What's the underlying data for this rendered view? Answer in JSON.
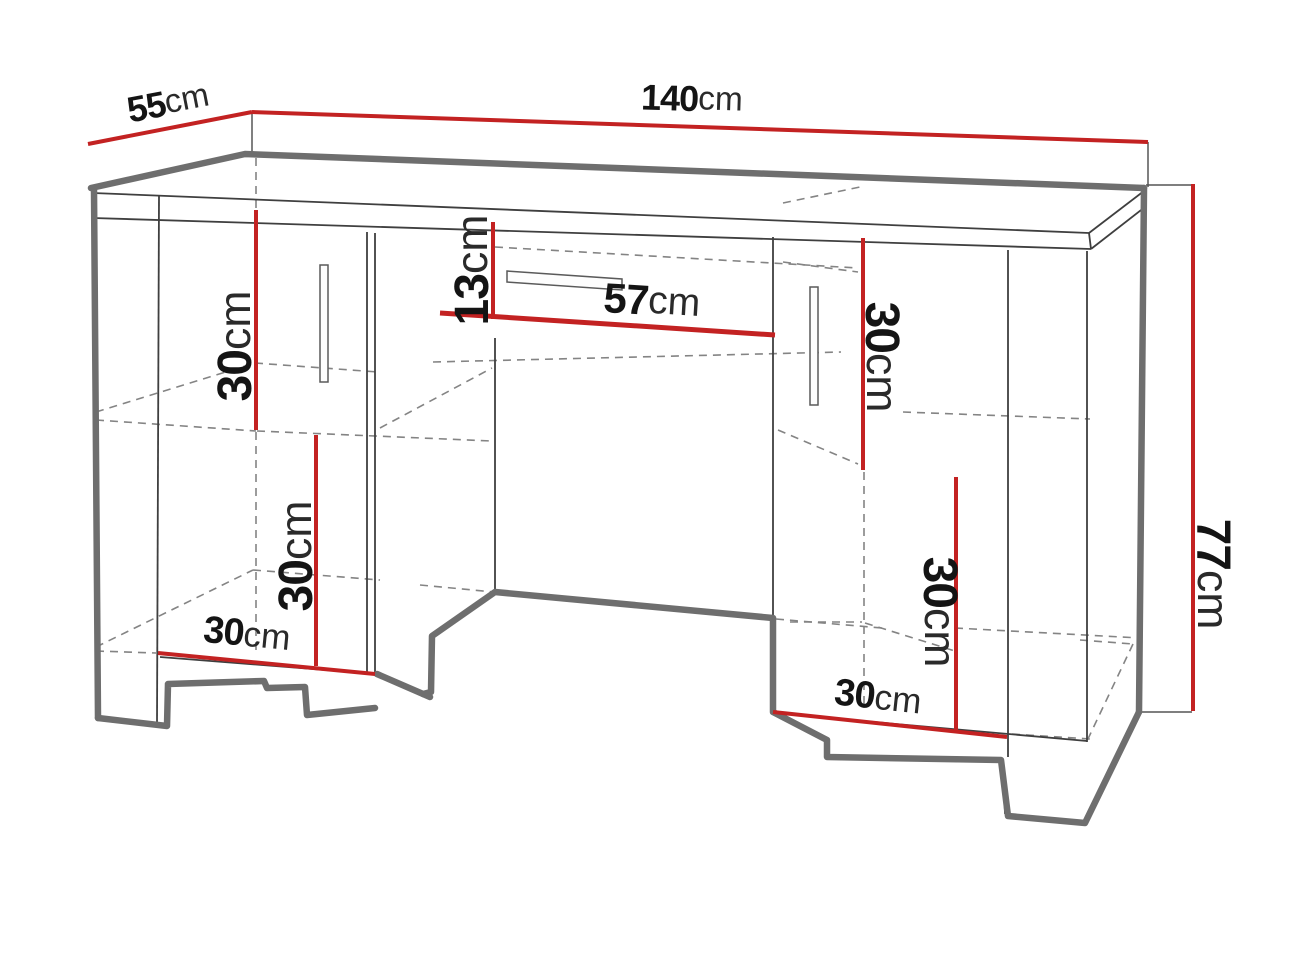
{
  "figure": {
    "kind": "furniture-dimension-diagram",
    "subject": "double pedestal desk line drawing with dimension callouts"
  },
  "colors": {
    "background": "#ffffff",
    "dimension_line": "#c32222",
    "outline_thick": "#6e6e6e",
    "edge_thin": "#3f3f3f",
    "hidden_dashed": "#848484",
    "label_text": "#141414"
  },
  "dimensions": {
    "depth": {
      "value": "55",
      "unit": "cm"
    },
    "width": {
      "value": "140",
      "unit": "cm"
    },
    "height": {
      "value": "77",
      "unit": "cm"
    },
    "left_upper_compartment_height": {
      "value": "30",
      "unit": "cm"
    },
    "left_lower_compartment_height": {
      "value": "30",
      "unit": "cm"
    },
    "left_pedestal_depth": {
      "value": "30",
      "unit": "cm"
    },
    "drawer_opening_height": {
      "value": "13",
      "unit": "cm"
    },
    "drawer_opening_width": {
      "value": "57",
      "unit": "cm"
    },
    "right_upper_compartment_height": {
      "value": "30",
      "unit": "cm"
    },
    "right_lower_compartment_height": {
      "value": "30",
      "unit": "cm"
    },
    "right_pedestal_depth": {
      "value": "30",
      "unit": "cm"
    }
  }
}
